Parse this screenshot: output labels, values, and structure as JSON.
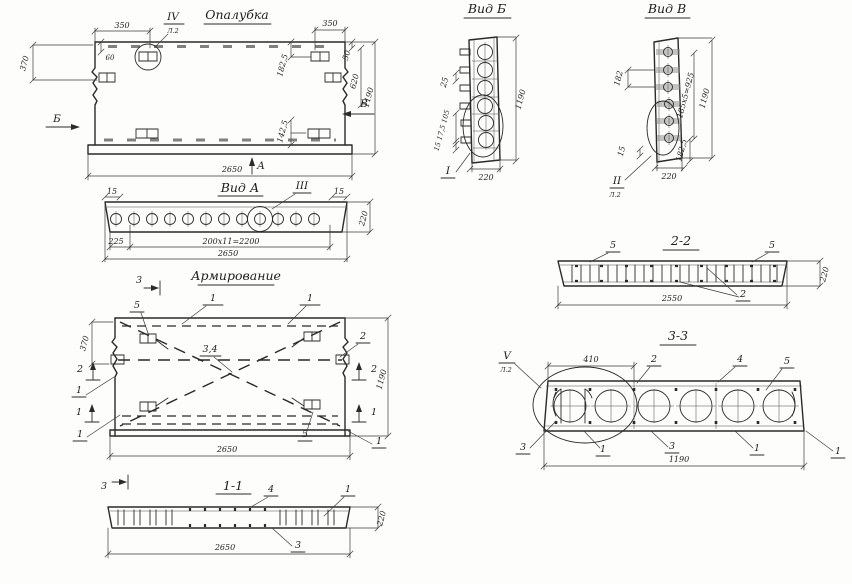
{
  "sheet": {
    "background": "#fdfdfb",
    "ink": "#2a2a2a"
  },
  "formwork": {
    "title": "Опалубка",
    "detail_iv": "IV",
    "sheet_ref": "Л.2",
    "dim_350_left": "350",
    "dim_350_right": "350",
    "dim_60": "60",
    "dim_370": "370",
    "dim_182_5": "182,5",
    "dim_50": "50",
    "dim_620": "620",
    "dim_1190": "1190",
    "dim_142_5": "142,5",
    "dim_2650": "2650",
    "arrow_b": "Б",
    "arrow_v": "В",
    "arrow_a": "А"
  },
  "view_a": {
    "title": "Вид А",
    "detail_iii": "III",
    "dim_15_left": "15",
    "dim_15_right": "15",
    "dim_225": "225",
    "dim_spacing": "200х11=2200",
    "dim_2650": "2650",
    "dim_220": "220"
  },
  "view_b": {
    "title": "Вид Б",
    "detail_i": "I",
    "dim_25": "25",
    "dim_stack": "15 17,5 105",
    "dim_1190": "1190",
    "dim_220": "220"
  },
  "view_v": {
    "title": "Вид В",
    "detail_ii": "II",
    "sheet_ref": "Л.2",
    "dim_182": "182",
    "dim_spacing": "185х5=925",
    "dim_1190": "1190",
    "dim_15": "15",
    "dim_182_5": "182,5",
    "dim_220": "220"
  },
  "reinforcement": {
    "title": "Армирование",
    "callout_1": "1",
    "callout_2": "2",
    "callout_34": "3,4",
    "callout_5": "5",
    "marker_1": "1",
    "marker_2": "2",
    "marker_3": "3",
    "dim_370": "370",
    "dim_1190": "1190",
    "dim_2650": "2650"
  },
  "section_1_1": {
    "title": "1-1",
    "callout_4": "4",
    "callout_1": "1",
    "callout_3": "3",
    "dim_2650": "2650",
    "dim_220": "220"
  },
  "section_2_2": {
    "title": "2-2",
    "callout_5": "5",
    "callout_2": "2",
    "dim_2550": "2550",
    "dim_220": "220"
  },
  "section_3_3": {
    "title": "3-3",
    "detail_v": "V",
    "sheet_ref": "Л.2",
    "callout_1": "1",
    "callout_2": "2",
    "callout_3": "3",
    "callout_4": "4",
    "callout_5": "5",
    "dim_410": "410",
    "dim_1190": "1190"
  }
}
